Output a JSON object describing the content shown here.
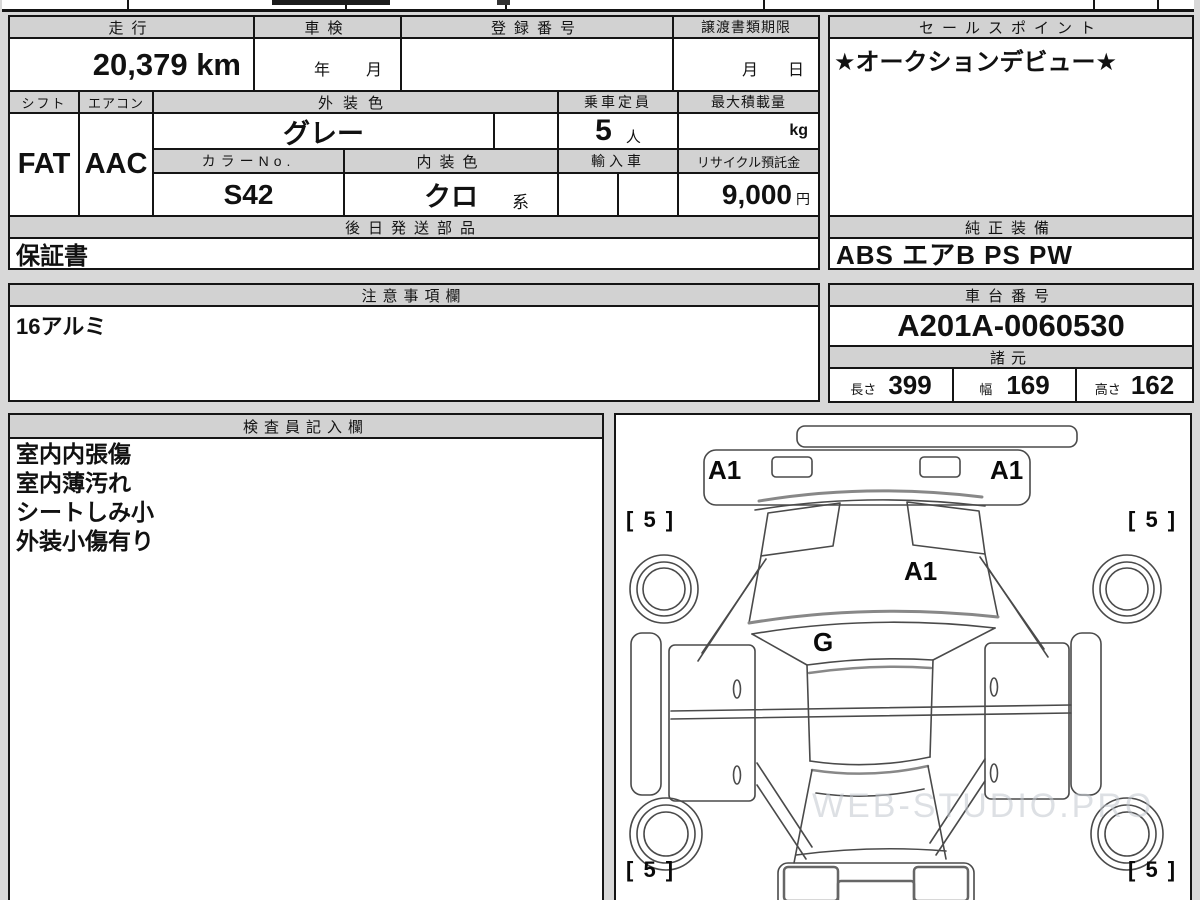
{
  "main": {
    "h_mileage": "走行",
    "h_inspection": "車検",
    "h_registration": "登録番号",
    "h_transfer_deadline": "譲渡書類期限",
    "mileage": "20,379 km",
    "u_year": "年",
    "u_month": "月",
    "u_month2": "月",
    "u_day": "日",
    "h_shift": "シフト",
    "h_aircon": "エアコン",
    "h_ext_color": "外装色",
    "h_capacity": "乗車定員",
    "h_max_load": "最大積載量",
    "shift": "FAT",
    "aircon": "AAC",
    "ext_color": "グレー",
    "capacity": "5",
    "capacity_unit": "人",
    "max_load_unit": "kg",
    "h_color_no": "カラーNo.",
    "h_int_color": "内装色",
    "h_import": "輸入車",
    "h_recycle": "リサイクル預託金",
    "color_no": "S42",
    "int_color": "クロ",
    "int_color_suffix": "系",
    "recycle_fee": "9,000",
    "recycle_unit": "円",
    "h_later_parts": "後日発送部品",
    "later_parts": "保証書"
  },
  "sales": {
    "header": "セールスポイント",
    "point": "★オークションデビュー★",
    "h_equipment": "純正装備",
    "equipment": "ABS エアB PS PW"
  },
  "notes": {
    "header": "注意事項欄",
    "text": "16アルミ"
  },
  "chassis": {
    "header": "車台番号",
    "number": "A201A-0060530",
    "h_specs": "諸元",
    "dims": [
      {
        "label": "長さ",
        "value": "399"
      },
      {
        "label": "幅",
        "value": "169"
      },
      {
        "label": "高さ",
        "value": "162"
      }
    ]
  },
  "inspector": {
    "header": "検査員記入欄",
    "items": [
      "室内内張傷",
      "室内薄汚れ",
      "シートしみ小",
      "外装小傷有り"
    ]
  },
  "diagram": {
    "mark_front_left": "A1",
    "mark_front_right": "A1",
    "mark_hood": "A1",
    "mark_glass": "G",
    "tire_front_left": "[ 5 ]",
    "tire_front_right": "[ 5 ]",
    "tire_rear_left": "[ 5 ]",
    "tire_rear_right": "[ 5 ]",
    "watermark": "WEB-STUDIO.PRO"
  }
}
